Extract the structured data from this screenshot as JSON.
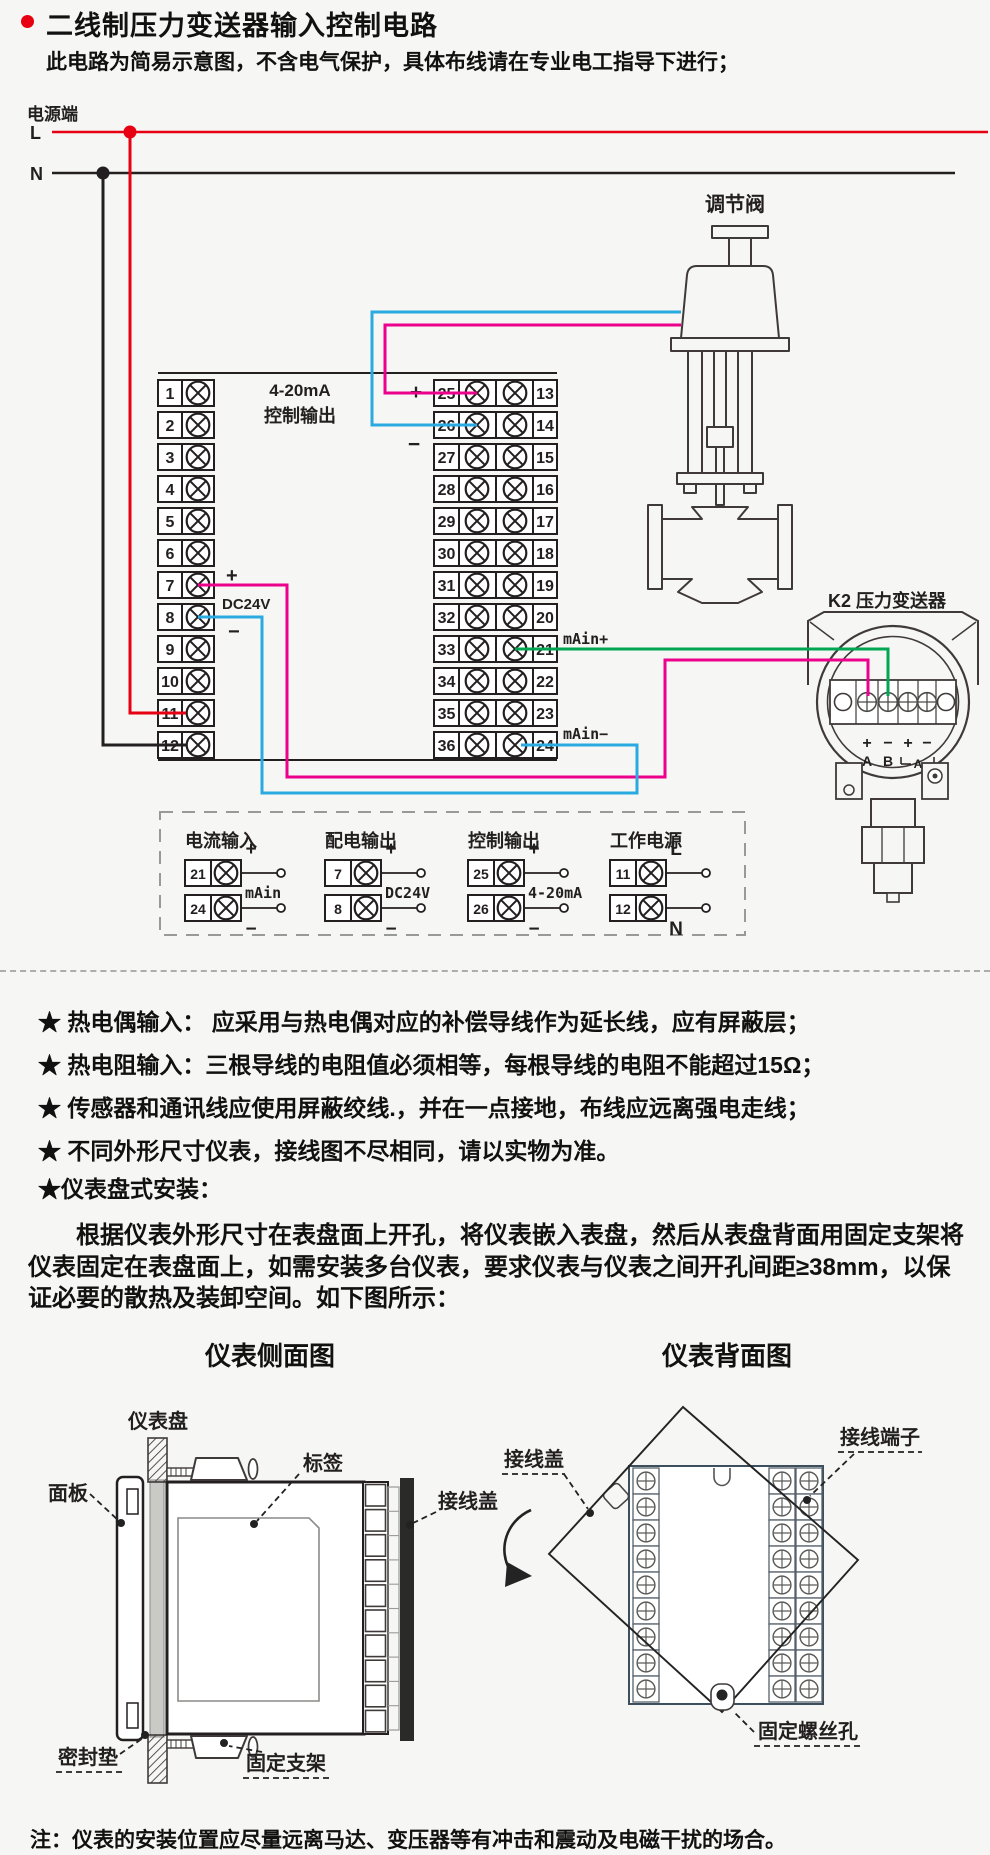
{
  "header": {
    "title": "二线制压力变送器输入控制电路",
    "subtitle": "此电路为简易示意图，不含电气保护，具体布线请在专业电工指导下进行；"
  },
  "colors": {
    "red": "#e60012",
    "black": "#231f20",
    "cyan": "#29abe2",
    "magenta": "#ec008c",
    "green": "#00a651"
  },
  "wiring": {
    "power_label": "电源端",
    "l": "L",
    "n": "N",
    "out_line1": "4-20mA",
    "out_line2": "控制输出",
    "plus": "+",
    "minus": "−",
    "dc24v": "DC24V",
    "main_plus": "mAin+",
    "main_minus": "mAin−",
    "valve_label": "调节阀",
    "transmitter_label": "K2 压力变送器",
    "pins": [
      "+",
      "−",
      "+",
      "−"
    ],
    "pin_a": "A",
    "pin_b": "B",
    "ammeter": "A",
    "left_terminals": [
      "1",
      "2",
      "3",
      "4",
      "5",
      "6",
      "7",
      "8",
      "9",
      "10",
      "11",
      "12"
    ],
    "center_left_terminals": [
      "25",
      "26",
      "27",
      "28",
      "29",
      "30",
      "31",
      "32",
      "33",
      "34",
      "35",
      "36"
    ],
    "center_right_terminals": [
      "13",
      "14",
      "15",
      "16",
      "17",
      "18",
      "19",
      "20",
      "21",
      "22",
      "23",
      "24"
    ]
  },
  "legend": {
    "groups": [
      {
        "title": "电流输入",
        "rows": [
          {
            "num": "21",
            "sign": "+"
          },
          {
            "num": "24",
            "sign": "−"
          }
        ],
        "label": "mAin"
      },
      {
        "title": "配电输出",
        "rows": [
          {
            "num": "7",
            "sign": "+"
          },
          {
            "num": "8",
            "sign": "−"
          }
        ],
        "label": "DC24V"
      },
      {
        "title": "控制输出",
        "rows": [
          {
            "num": "25",
            "sign": "+"
          },
          {
            "num": "26",
            "sign": "−"
          }
        ],
        "label": "4-20mA"
      },
      {
        "title": "工作电源",
        "rows": [
          {
            "num": "11",
            "sign": "L"
          },
          {
            "num": "12",
            "sign": "N"
          }
        ],
        "label": ""
      }
    ]
  },
  "notes": {
    "items": [
      "★ 热电偶输入： 应采用与热电偶对应的补偿导线作为延长线，应有屏蔽层；",
      "★ 热电阻输入：三根导线的电阻值必须相等，每根导线的电阻不能超过15Ω；",
      "★ 传感器和通讯线应使用屏蔽绞线.，并在一点接地，布线应远离强电走线；",
      "★ 不同外形尺寸仪表，接线图不尽相同，请以实物为准。",
      "★仪表盘式安装："
    ]
  },
  "install": {
    "paragraph": "根据仪表外形尺寸在表盘面上开孔，将仪表嵌入表盘，然后从表盘背面用固定支架将仪表固定在表盘面上，如需安装多台仪表，要求仪表与仪表之间开孔间距≥38mm，以保证必要的散热及装卸空间。如下图所示：",
    "side": {
      "title": "仪表侧面图",
      "panel": "仪表盘",
      "faceplate": "面板",
      "tag": "标签",
      "cover": "接线盖",
      "gasket": "密封垫",
      "bracket": "固定支架"
    },
    "back": {
      "title": "仪表背面图",
      "cover": "接线盖",
      "terminal": "接线端子",
      "screw_hole": "固定螺丝孔"
    }
  },
  "footer": {
    "note": "注：仪表的安装位置应尽量远离马达、变压器等有冲击和震动及电磁干扰的场合。"
  }
}
